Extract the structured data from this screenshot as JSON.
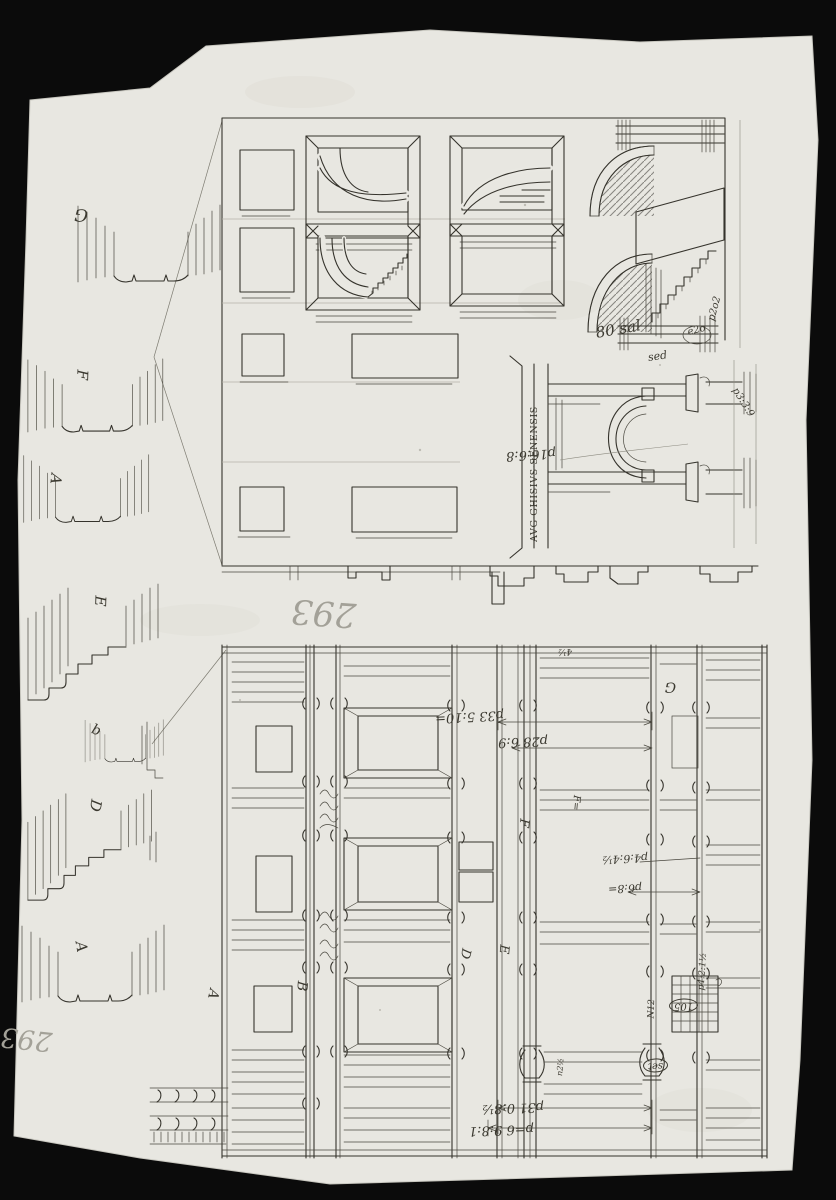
{
  "sheet": {
    "folio_number": "293",
    "folio_number_repeat": "293"
  },
  "profiles": {
    "labels": [
      "G",
      "F",
      "A",
      "E",
      "b",
      "D",
      "A"
    ]
  },
  "upper_elevation": {
    "stairs_note": "80 sal",
    "stairs_circle_note": "e2o",
    "stairs_side_note": "p2o2",
    "portal": {
      "inscription": "AVG·GHISIVS·SENENSIS",
      "width_dim": "p16:6:8",
      "top_note": "sed",
      "top_dim": "p3:3:9"
    }
  },
  "lower_elevation": {
    "top_tick": "4½",
    "bay_letters": {
      "a": "A",
      "b": "B",
      "d": "D",
      "e": "E",
      "f": "F",
      "f_eq": "F=",
      "g": "G"
    },
    "dims": {
      "width_upper": "p33 5:10=",
      "width_lower": "p28 6:9",
      "right_upper": "p4:6:4½",
      "right_mid": "p6:8=",
      "right_vertical": "p4:2:1½",
      "niche_no": "N12",
      "grille_circle": "105",
      "base_circle": "set",
      "bottom_upper": "p31 0:8½",
      "bottom_lower": "p=6 9:8:1",
      "rail_note": "n2½"
    }
  }
}
